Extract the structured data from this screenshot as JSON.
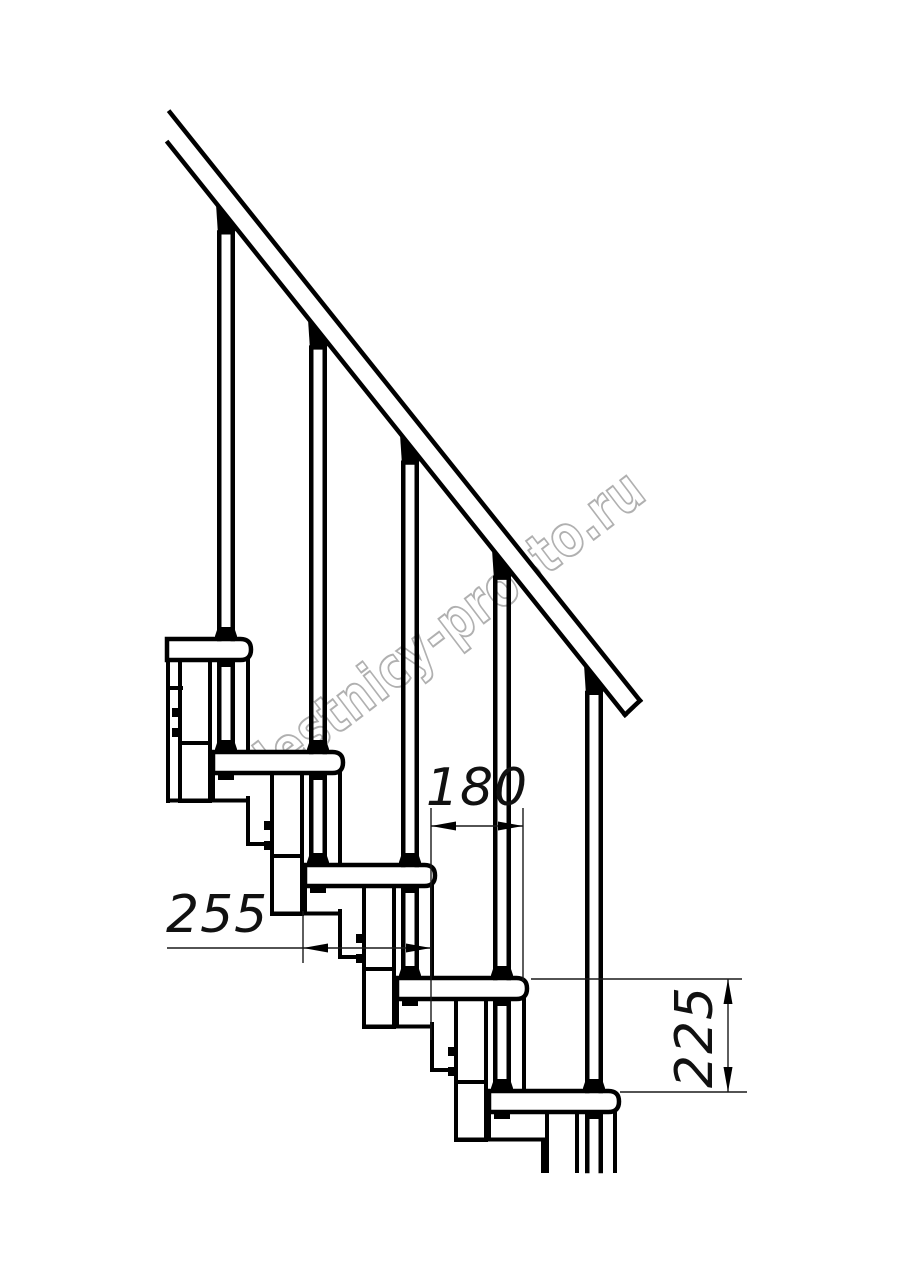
{
  "watermark": {
    "text": "lestnicy-prosto.ru",
    "color": "#b0b0b0"
  },
  "dimensions": {
    "run": {
      "value": "180",
      "orientation": "horizontal"
    },
    "depth": {
      "value": "255",
      "orientation": "horizontal"
    },
    "rise": {
      "value": "225",
      "orientation": "vertical"
    }
  },
  "colors": {
    "line": "#000000",
    "background": "#ffffff",
    "dimension_text": "#111111"
  },
  "structure": {
    "treads": 5,
    "balusters": 5,
    "support_columns": 5,
    "support_pipes": 5,
    "handrail": true
  }
}
